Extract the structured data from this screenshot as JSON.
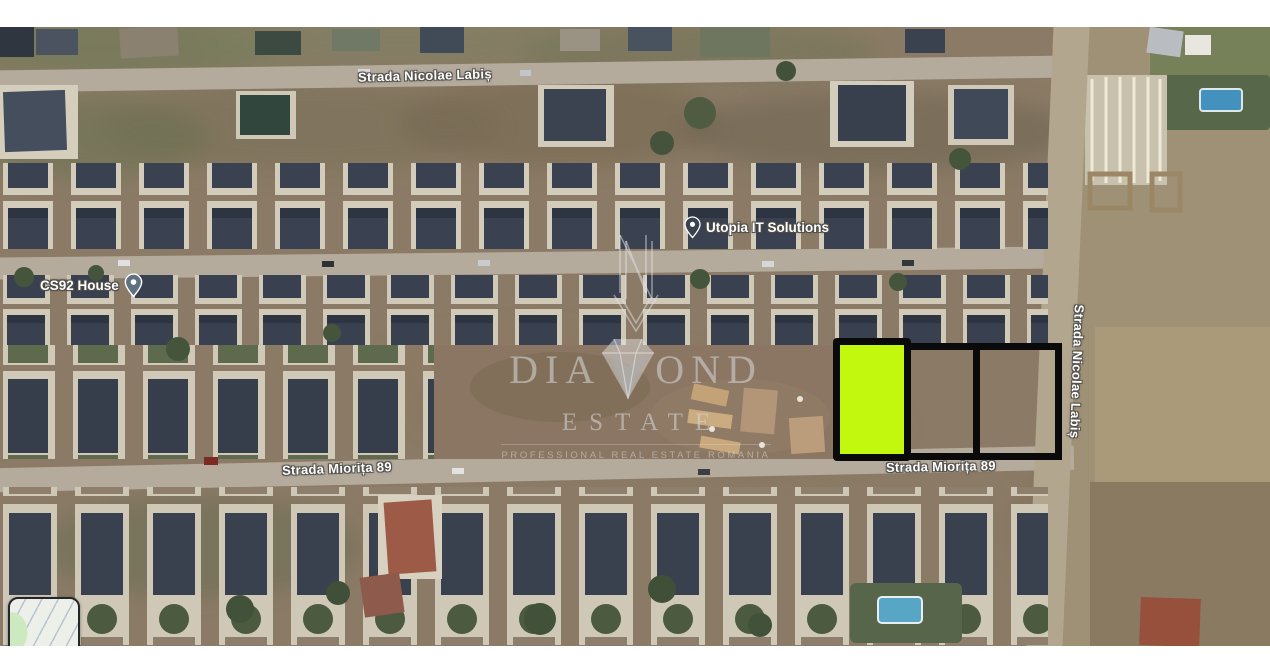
{
  "map": {
    "streets": {
      "nicolae_labis_top": "Strada Nicolae Labiș",
      "nicolae_labis_right": "Strada Nicolae Labiș",
      "miorita_left": "Strada Miorița 89",
      "miorita_right": "Strada Miorița 89"
    },
    "pois": [
      {
        "label": "Utopia IT Solutions"
      },
      {
        "label": "CS92 House"
      }
    ]
  },
  "watermark": {
    "brand_left": "DIA",
    "brand_right": "OND",
    "brand_full": "DIAMOND",
    "line2": "ESTATE",
    "tagline": "PROFESSIONAL REAL ESTATE ROMANIA"
  },
  "plots": {
    "count": 3,
    "highlight_fill": "#c2f70e",
    "outline_color": "#0a0a0a"
  },
  "colors": {
    "label_text": "#ffffff",
    "label_halo": "#54524d",
    "pin_utopia": "#39434e",
    "pin_cs92": "#5d7181"
  }
}
